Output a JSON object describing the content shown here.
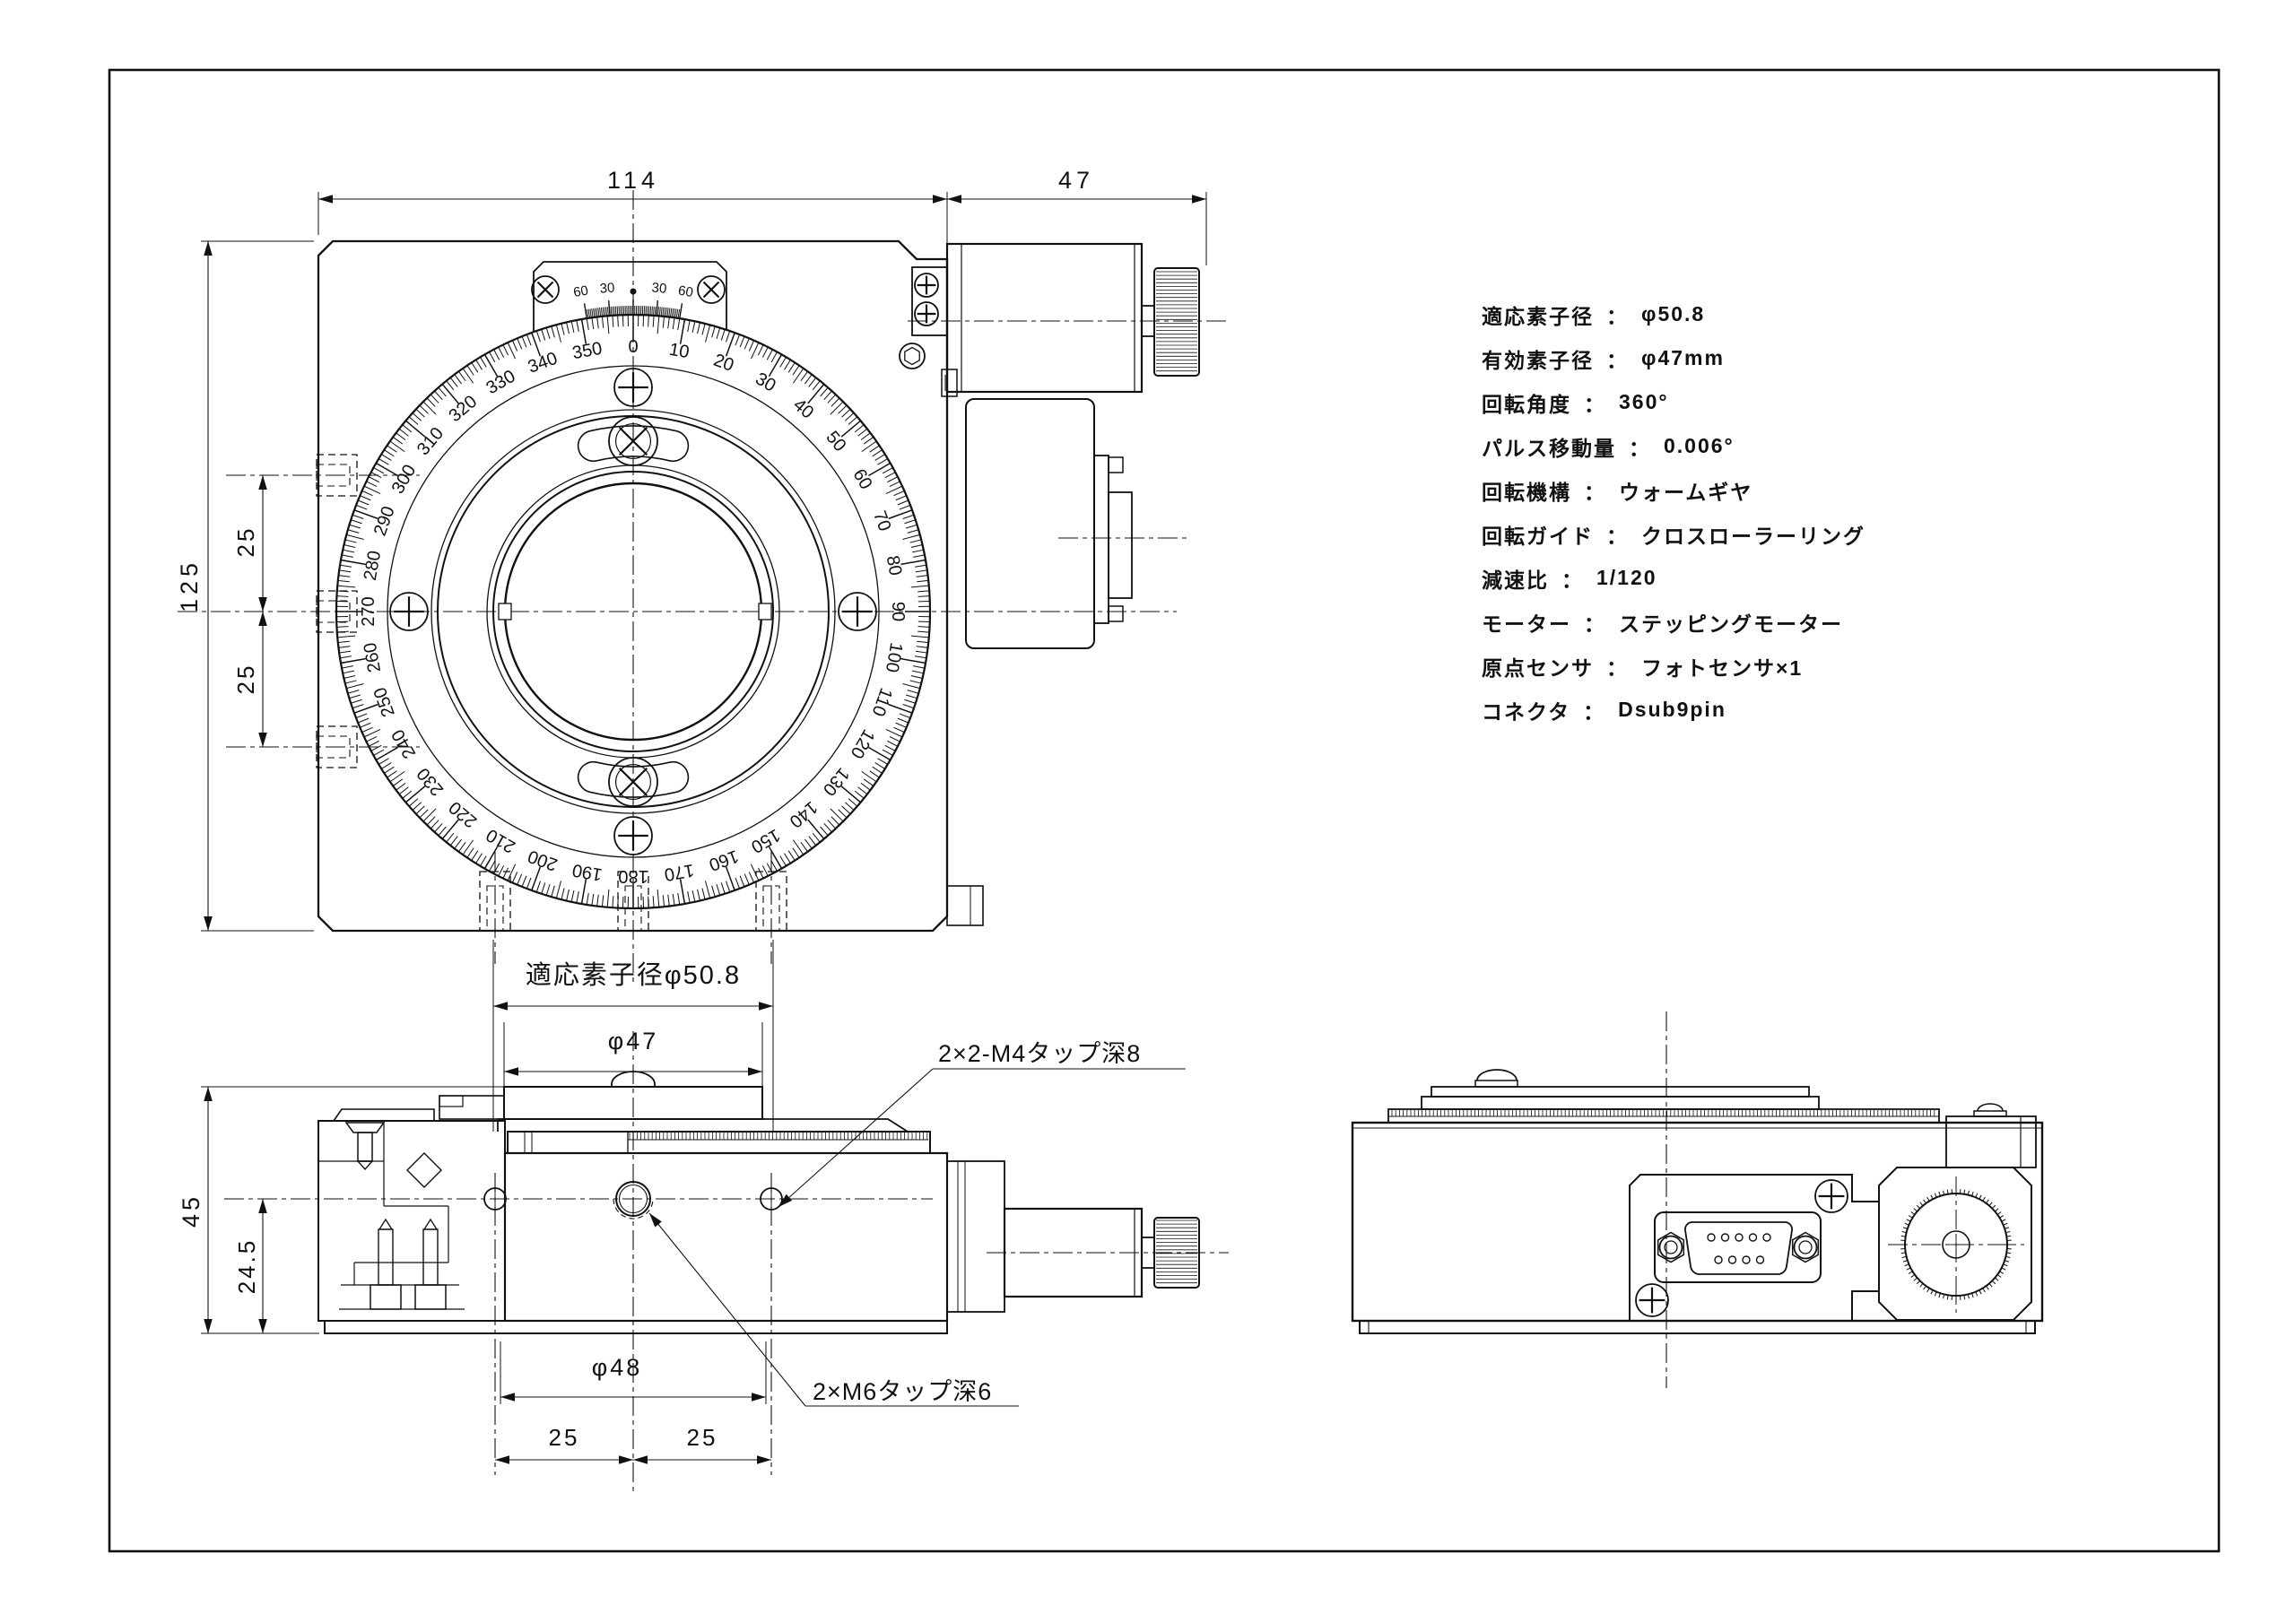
{
  "ui": {
    "colon": "："
  },
  "specs": [
    {
      "label": "適応素子径",
      "value": "φ50.8"
    },
    {
      "label": "有効素子径",
      "value": "φ47mm"
    },
    {
      "label": "回転角度",
      "value": "360°"
    },
    {
      "label": "パルス移動量",
      "value": "0.006°"
    },
    {
      "label": "回転機構",
      "value": "ウォームギヤ"
    },
    {
      "label": "回転ガイド",
      "value": "クロスローラーリング"
    },
    {
      "label": "減速比",
      "value": "1/120"
    },
    {
      "label": "モーター",
      "value": "ステッピングモーター"
    },
    {
      "label": "原点センサ",
      "value": "フォトセンサ×1"
    },
    {
      "label": "コネクタ",
      "value": "Dsub9pin"
    }
  ],
  "dimensions": {
    "top_width": "114",
    "motor_width": "47",
    "body_height": "125",
    "pitch_upper": "25",
    "pitch_lower": "25",
    "aperture_label": "適応素子径φ50.8",
    "effective_dia": "φ47",
    "side_height": "45",
    "hole_height": "24.5",
    "bolt_circle": "φ48",
    "pitch_left": "25",
    "pitch_right": "25"
  },
  "callouts": {
    "m4": "2×2-M4タップ深8",
    "m6": "2×M6タップ深6"
  },
  "dial": {
    "numbers": [
      "0",
      "10",
      "20",
      "30",
      "40",
      "50",
      "60",
      "70",
      "80",
      "90",
      "100",
      "110",
      "120",
      "130",
      "140",
      "150",
      "160",
      "170",
      "180",
      "190",
      "200",
      "210",
      "220",
      "230",
      "240",
      "250",
      "260",
      "270",
      "280",
      "290",
      "300",
      "310",
      "320",
      "330",
      "340",
      "350"
    ],
    "vernier_labels": [
      "60",
      "30",
      "30",
      "60"
    ]
  }
}
